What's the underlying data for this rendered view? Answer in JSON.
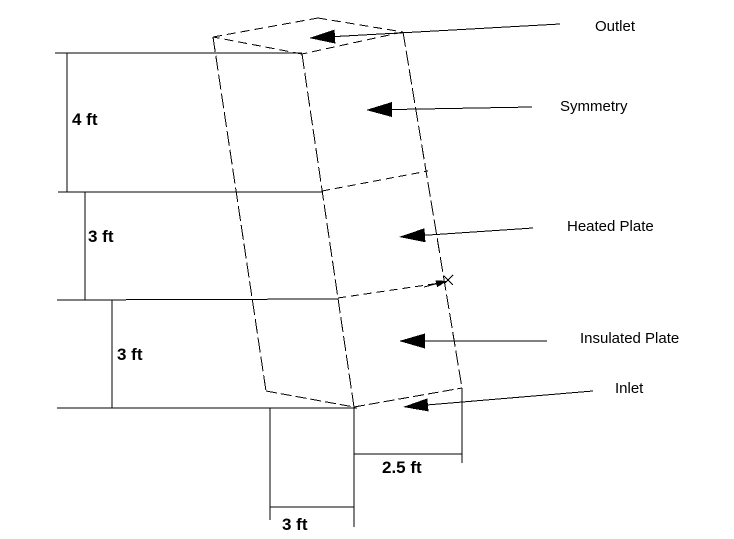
{
  "page": {
    "background_color": "#ffffff",
    "line_color": "#000000"
  },
  "labels": {
    "outlet": {
      "text": "Outlet"
    },
    "symmetry": {
      "text": "Symmetry"
    },
    "heated_plate": {
      "text": "Heated Plate"
    },
    "insulated_plate": {
      "text": "Insulated Plate"
    },
    "inlet": {
      "text": "Inlet"
    }
  },
  "dimensions": {
    "upper_height": {
      "text": "4 ft"
    },
    "middle_height": {
      "text": "3 ft"
    },
    "lower_height": {
      "text": "3 ft"
    },
    "base_right": {
      "text": "2.5 ft"
    },
    "base_bottom": {
      "text": "3 ft"
    }
  },
  "geometry": {
    "stroke": "#000000",
    "lines": [
      {
        "name": "ext-line-top",
        "x1": 55,
        "y1": 53,
        "x2": 302,
        "y2": 53,
        "dash": null
      },
      {
        "name": "dim-4ft-vertical",
        "x1": 67,
        "y1": 53,
        "x2": 67,
        "y2": 192,
        "dash": null
      },
      {
        "name": "ext-line-2",
        "x1": 58,
        "y1": 192,
        "x2": 322,
        "y2": 192,
        "dash": null
      },
      {
        "name": "dim-3ft-a-vertical",
        "x1": 85,
        "y1": 192,
        "x2": 85,
        "y2": 300,
        "dash": null
      },
      {
        "name": "ext-line-3",
        "x1": 57,
        "y1": 300,
        "x2": 338,
        "y2": 299,
        "dash": null
      },
      {
        "name": "dim-3ft-b-vertical",
        "x1": 112,
        "y1": 300,
        "x2": 112,
        "y2": 408,
        "dash": null
      },
      {
        "name": "ext-line-4",
        "x1": 57,
        "y1": 408,
        "x2": 357,
        "y2": 408,
        "dash": null
      },
      {
        "name": "ext-bottom-left",
        "x1": 270,
        "y1": 408,
        "x2": 270,
        "y2": 520,
        "dash": null
      },
      {
        "name": "ext-bottom-mid",
        "x1": 354,
        "y1": 407,
        "x2": 354,
        "y2": 527,
        "dash": null
      },
      {
        "name": "dim-3ft-bottom-line",
        "x1": 270,
        "y1": 507,
        "x2": 354,
        "y2": 507,
        "dash": null
      },
      {
        "name": "ext-bottom-right",
        "x1": 462,
        "y1": 388,
        "x2": 462,
        "y2": 463,
        "dash": null
      },
      {
        "name": "dim-2p5ft-line",
        "x1": 354,
        "y1": 454,
        "x2": 462,
        "y2": 454,
        "dash": null
      },
      {
        "name": "box-top-back-left",
        "x1": 213,
        "y1": 37,
        "x2": 318,
        "y2": 18,
        "dash": "9 5"
      },
      {
        "name": "box-top-back-right",
        "x1": 318,
        "y1": 18,
        "x2": 403,
        "y2": 32,
        "dash": "9 5"
      },
      {
        "name": "box-top-front-right",
        "x1": 403,
        "y1": 32,
        "x2": 302,
        "y2": 54,
        "dash": "9 5"
      },
      {
        "name": "box-top-front-left",
        "x1": 302,
        "y1": 54,
        "x2": 213,
        "y2": 37,
        "dash": "9 5"
      },
      {
        "name": "box-edge-left",
        "x1": 213,
        "y1": 37,
        "x2": 266,
        "y2": 391,
        "dash": "15 4"
      },
      {
        "name": "box-edge-front",
        "x1": 302,
        "y1": 54,
        "x2": 354,
        "y2": 407,
        "dash": "15 4"
      },
      {
        "name": "box-edge-right",
        "x1": 403,
        "y1": 32,
        "x2": 462,
        "y2": 388,
        "dash": "15 4"
      },
      {
        "name": "box-bottom-left-edge",
        "x1": 266,
        "y1": 391,
        "x2": 354,
        "y2": 407,
        "dash": "11 4"
      },
      {
        "name": "box-bottom-right-edge",
        "x1": 354,
        "y1": 407,
        "x2": 462,
        "y2": 388,
        "dash": "11 4"
      },
      {
        "name": "divider-heated-top",
        "x1": 322,
        "y1": 191,
        "x2": 428,
        "y2": 171,
        "dash": "8 5"
      },
      {
        "name": "divider-insulated-top",
        "x1": 338,
        "y1": 298,
        "x2": 440,
        "y2": 283,
        "dash": "8 5"
      },
      {
        "name": "x-mark-stroke-1",
        "x1": 444,
        "y1": 276,
        "x2": 453,
        "y2": 285,
        "dash": null
      },
      {
        "name": "x-mark-stroke-2",
        "x1": 453,
        "y1": 275,
        "x2": 444,
        "y2": 284,
        "dash": null
      }
    ],
    "arrows": [
      {
        "name": "outlet-arrow",
        "x1": 560,
        "y1": 24,
        "x2": 309,
        "y2": 38,
        "head_l": 26,
        "head_w": 14
      },
      {
        "name": "symmetry-arrow",
        "x1": 532,
        "y1": 107,
        "x2": 366,
        "y2": 110,
        "head_l": 26,
        "head_w": 15
      },
      {
        "name": "heated-plate-arrow",
        "x1": 533,
        "y1": 228,
        "x2": 399,
        "y2": 237,
        "head_l": 26,
        "head_w": 14
      },
      {
        "name": "insulated-plate-arrow",
        "x1": 547,
        "y1": 341,
        "x2": 399,
        "y2": 341,
        "head_l": 26,
        "head_w": 15
      },
      {
        "name": "inlet-arrow",
        "x1": 593,
        "y1": 391,
        "x2": 403,
        "y2": 407,
        "head_l": 25,
        "head_w": 13
      },
      {
        "name": "divider-end-arrow",
        "x1": 424,
        "y1": 287,
        "x2": 447,
        "y2": 281,
        "head_l": 11,
        "head_w": 7
      }
    ]
  }
}
